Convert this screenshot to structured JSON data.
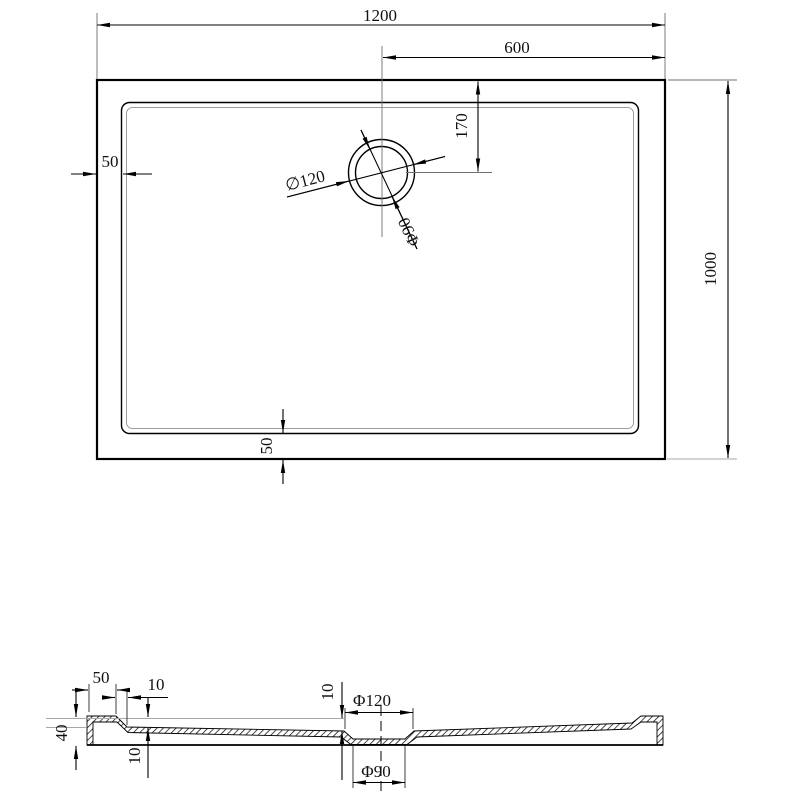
{
  "drawing": {
    "subject": "rectangular shower tray with round drain - dimensioned technical drawing",
    "background": "#ffffff",
    "colors": {
      "line": "#000000",
      "light_line": "#a8a8a8",
      "text": "#111111"
    },
    "top_view": {
      "dims": {
        "overall_width": "1200",
        "drain_center_to_right": "600",
        "drain_center_from_top": "170",
        "rim_left": "50",
        "rim_bottom": "50",
        "overall_height": "1000",
        "drain_outer_dia": "∅120",
        "drain_inner_dia": "Φ90"
      }
    },
    "section_view": {
      "dims": {
        "rim_width": "50",
        "step_width": "10",
        "total_height": "40",
        "basin_depth": "10",
        "drain_drop": "10",
        "drain_recess_outer_dia": "Φ120",
        "drain_recess_inner_dia": "Φ90"
      }
    }
  }
}
